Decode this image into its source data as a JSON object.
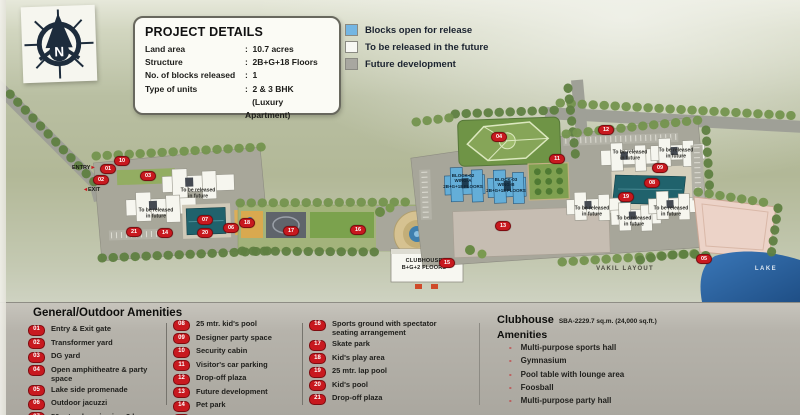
{
  "colors": {
    "accent_red": "#c8191f",
    "legend_blue": "#74b6e3",
    "legend_white": "#f8f8f4",
    "legend_gray": "#a8a7a0",
    "pool_teal": "#20626c",
    "lake_blue": "#2f6fb2"
  },
  "compass": {
    "letter": "N"
  },
  "project_details": {
    "title": "PROJECT DETAILS",
    "rows": [
      {
        "label": "Land area",
        "value": ":  10.7 acres"
      },
      {
        "label": "Structure",
        "value": ":  2B+G+18 Floors"
      },
      {
        "label": "No. of blocks released",
        "value": ":  1"
      },
      {
        "label": "Type of units",
        "value": ":  2 & 3 BHK\n   (Luxury Apartment)"
      }
    ]
  },
  "legend": {
    "items": [
      {
        "label": "Blocks open for release",
        "color": "#74b6e3"
      },
      {
        "label": "To be released in the future",
        "color": "#f8f8f4"
      },
      {
        "label": "Future development",
        "color": "#a8a7a0"
      }
    ]
  },
  "map": {
    "entry_label": "ENTRY",
    "entry_arrow": "▸",
    "exit_label": "EXIT",
    "exit_arrow": "◂",
    "to_be_released_label": "To be released\nin future",
    "tbr_positions": [
      {
        "x": 198,
        "y": 194
      },
      {
        "x": 156,
        "y": 214
      },
      {
        "x": 630,
        "y": 156
      },
      {
        "x": 676,
        "y": 154
      },
      {
        "x": 592,
        "y": 212
      },
      {
        "x": 634,
        "y": 222
      },
      {
        "x": 671,
        "y": 212
      }
    ],
    "blocks": [
      {
        "text": "BLOCK-02\nWING-A\n2B+G+18 FLOORS",
        "x": 463,
        "y": 181
      },
      {
        "text": "BLOCK-03\nWING-B\n2B+G+18 FLOORS",
        "x": 506,
        "y": 185
      }
    ],
    "clubhouse_label": "CLUBHOUSE\nB+G+2 FLOORS",
    "vakil_layout_label": "VAKIL LAYOUT",
    "lake_label": "LAKE",
    "markers": [
      {
        "n": "01",
        "x": 108,
        "y": 169
      },
      {
        "n": "10",
        "x": 122,
        "y": 161
      },
      {
        "n": "02",
        "x": 101,
        "y": 180
      },
      {
        "n": "21",
        "x": 134,
        "y": 232
      },
      {
        "n": "03",
        "x": 148,
        "y": 176
      },
      {
        "n": "14",
        "x": 165,
        "y": 233
      },
      {
        "n": "07",
        "x": 205,
        "y": 220
      },
      {
        "n": "20",
        "x": 205,
        "y": 233
      },
      {
        "n": "06",
        "x": 231,
        "y": 228
      },
      {
        "n": "18",
        "x": 247,
        "y": 223
      },
      {
        "n": "17",
        "x": 291,
        "y": 231
      },
      {
        "n": "16",
        "x": 358,
        "y": 230
      },
      {
        "n": "15",
        "x": 447,
        "y": 263
      },
      {
        "n": "04",
        "x": 499,
        "y": 137
      },
      {
        "n": "13",
        "x": 503,
        "y": 226
      },
      {
        "n": "11",
        "x": 557,
        "y": 159
      },
      {
        "n": "12",
        "x": 606,
        "y": 130
      },
      {
        "n": "09",
        "x": 660,
        "y": 168
      },
      {
        "n": "08",
        "x": 652,
        "y": 183
      },
      {
        "n": "19",
        "x": 626,
        "y": 197
      },
      {
        "n": "05",
        "x": 704,
        "y": 259
      }
    ]
  },
  "amenities": {
    "title": "General/Outdoor Amenities",
    "columns": [
      [
        {
          "num": "01",
          "label": "Entry & Exit gate"
        },
        {
          "num": "02",
          "label": "Transformer yard"
        },
        {
          "num": "03",
          "label": "DG yard"
        },
        {
          "num": "04",
          "label": "Open amphitheatre & party space"
        },
        {
          "num": "05",
          "label": "Lake side promenade"
        },
        {
          "num": "06",
          "label": "Outdoor jacuzzi"
        },
        {
          "num": "07",
          "label": "50 mtr. olympic size, 3 lane swimming pool"
        }
      ],
      [
        {
          "num": "08",
          "label": "25 mtr. kid's pool"
        },
        {
          "num": "09",
          "label": "Designer party space"
        },
        {
          "num": "10",
          "label": "Security cabin"
        },
        {
          "num": "11",
          "label": "Visitor's car parking"
        },
        {
          "num": "12",
          "label": "Drop-off plaza"
        },
        {
          "num": "13",
          "label": "Future development"
        },
        {
          "num": "14",
          "label": "Pet park"
        },
        {
          "num": "15",
          "label": "Clubhouse with party lawn"
        }
      ],
      [
        {
          "num": "16",
          "label": "Sports ground with spectator seating arrangement"
        },
        {
          "num": "17",
          "label": "Skate park"
        },
        {
          "num": "18",
          "label": "Kid's play area"
        },
        {
          "num": "19",
          "label": "25 mtr. lap pool"
        },
        {
          "num": "20",
          "label": "Kid's pool"
        },
        {
          "num": "21",
          "label": "Drop-off plaza"
        }
      ]
    ]
  },
  "clubhouse": {
    "title": "Clubhouse",
    "sba": "SBA-2229.7 sq.m. (24,000 sq.ft.)",
    "subtitle": "Amenities",
    "bullet": "-",
    "items": [
      "Multi-purpose sports hall",
      "Gymnasium",
      "Pool table with lounge area",
      "Foosball",
      "Multi-purpose party hall"
    ]
  }
}
